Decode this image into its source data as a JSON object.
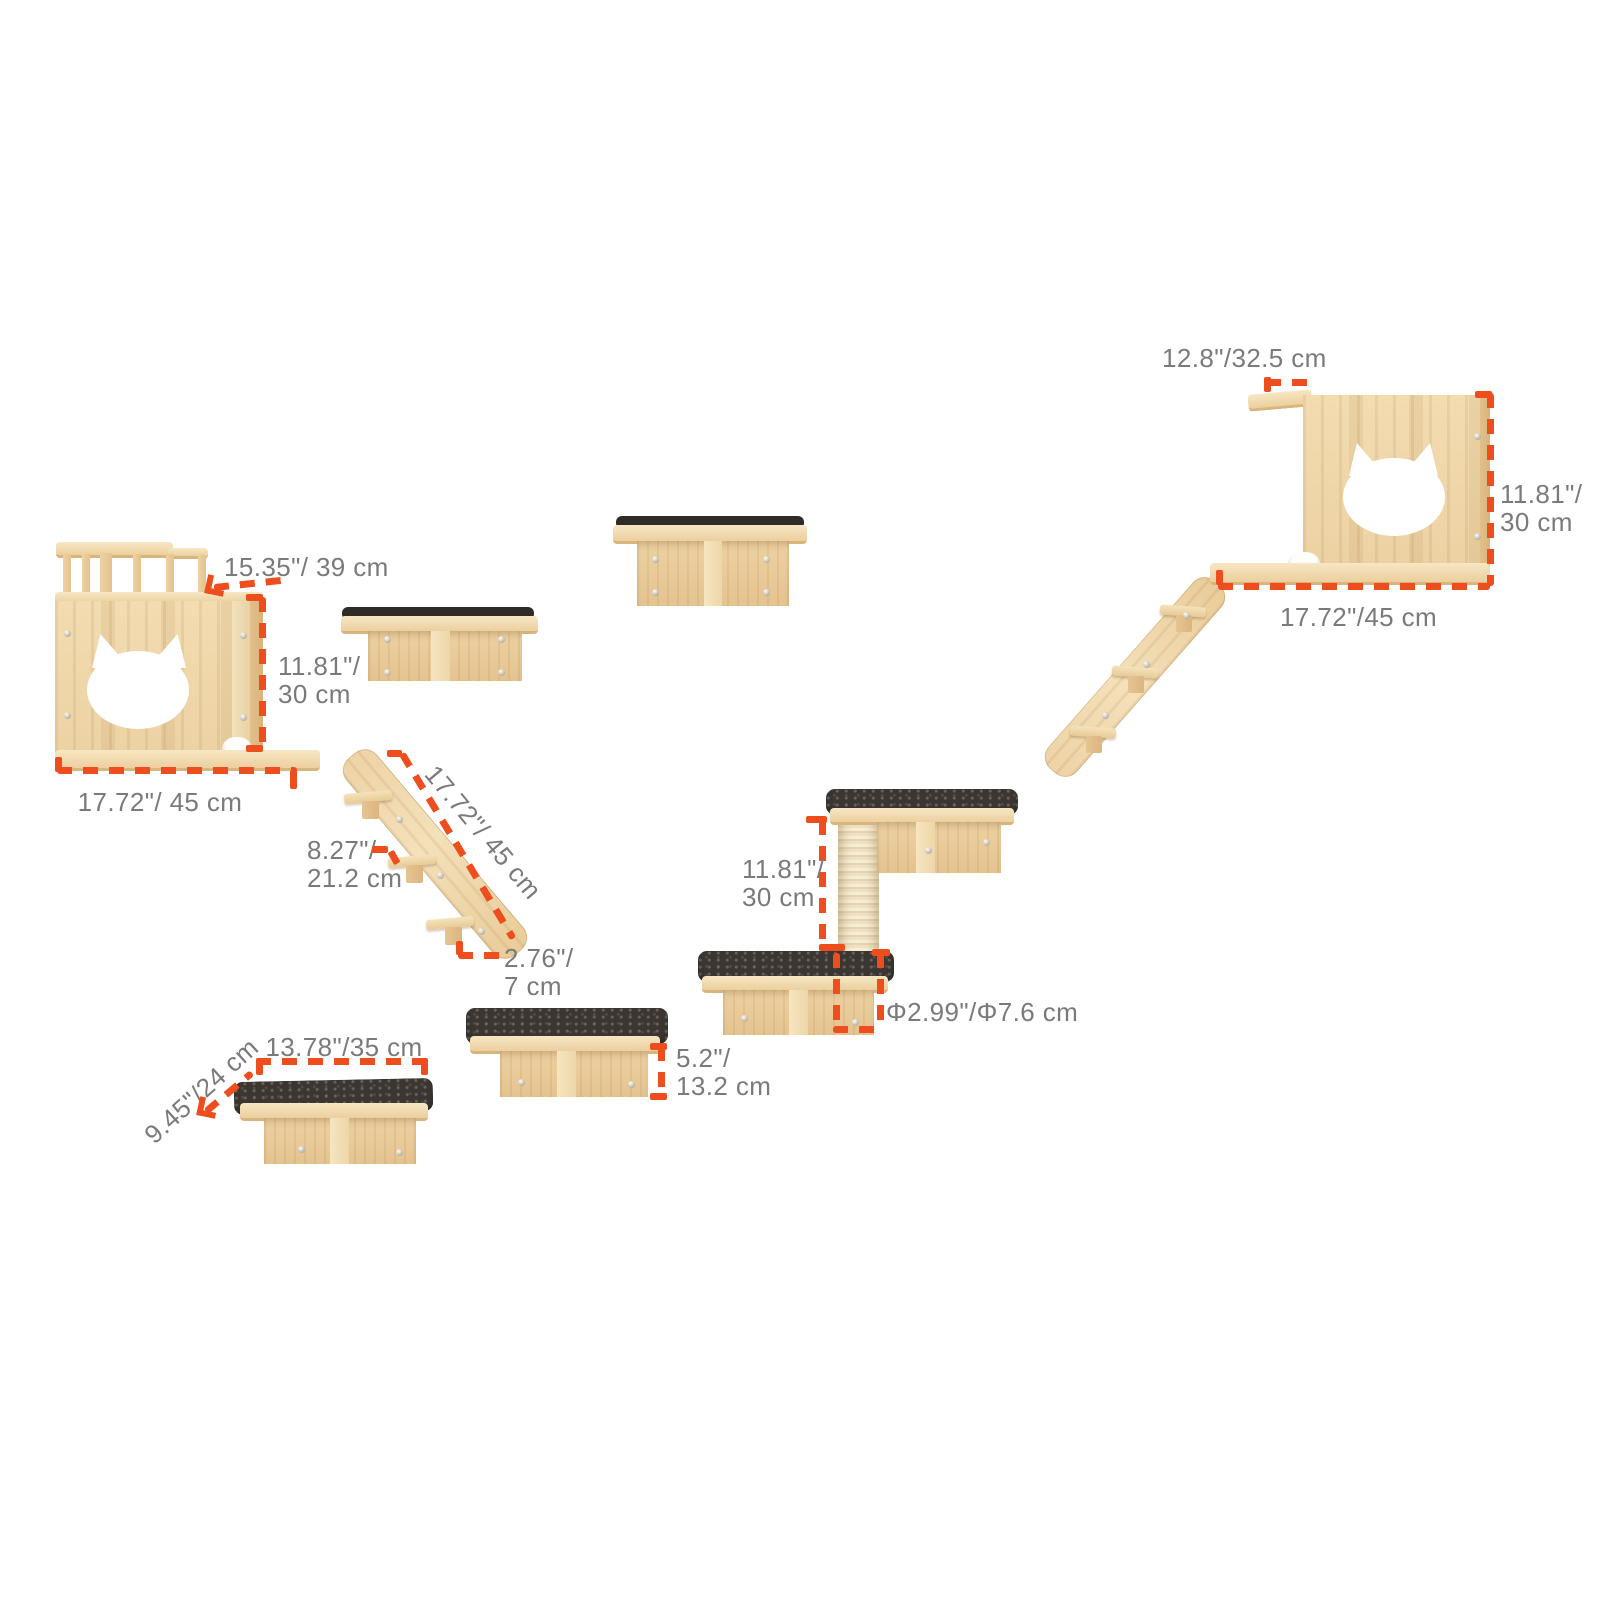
{
  "colors": {
    "background": "#FFFFFF",
    "accent_orange": "#EE4D1E",
    "label_gray": "#7A7A7A",
    "wood_light": "#F2DCB0",
    "wood_dark": "#D9B57E",
    "mat_dark": "#3B3631",
    "sisal": "#EFE2C3"
  },
  "pieces": {
    "left_house": {
      "name": "cat house with balcony",
      "dim_top": "15.35\"/ 39 cm",
      "dim_h1": "11.81\"/",
      "dim_h2": "30 cm",
      "dim_w": "17.72\"/ 45 cm"
    },
    "ladder_left": {
      "name": "climbing ladder",
      "dim_len": "17.72\"/ 45 cm",
      "dim_step1": "8.27\"/",
      "dim_step2": "21.2 cm",
      "dim_w1": "2.76\"/",
      "dim_w2": "7 cm"
    },
    "step_unit": {
      "name": "steps with scratching post",
      "dim_h1": "11.81\"/",
      "dim_h2": "30 cm",
      "dim_post": "Φ2.99\"/Φ7.6 cm"
    },
    "shelf_middle": {
      "name": "wall step with mat",
      "dim_h1": "5.2\"/",
      "dim_h2": "13.2 cm"
    },
    "shelf_bottom": {
      "name": "wall step with mat",
      "dim_w": "13.78\"/35 cm",
      "dim_d": "9.45\"/24 cm"
    },
    "right_house": {
      "name": "cat house",
      "dim_top": "12.8\"/32.5 cm",
      "dim_h1": "11.81\"/",
      "dim_h2": "30 cm",
      "dim_w": "17.72\"/45 cm"
    }
  }
}
